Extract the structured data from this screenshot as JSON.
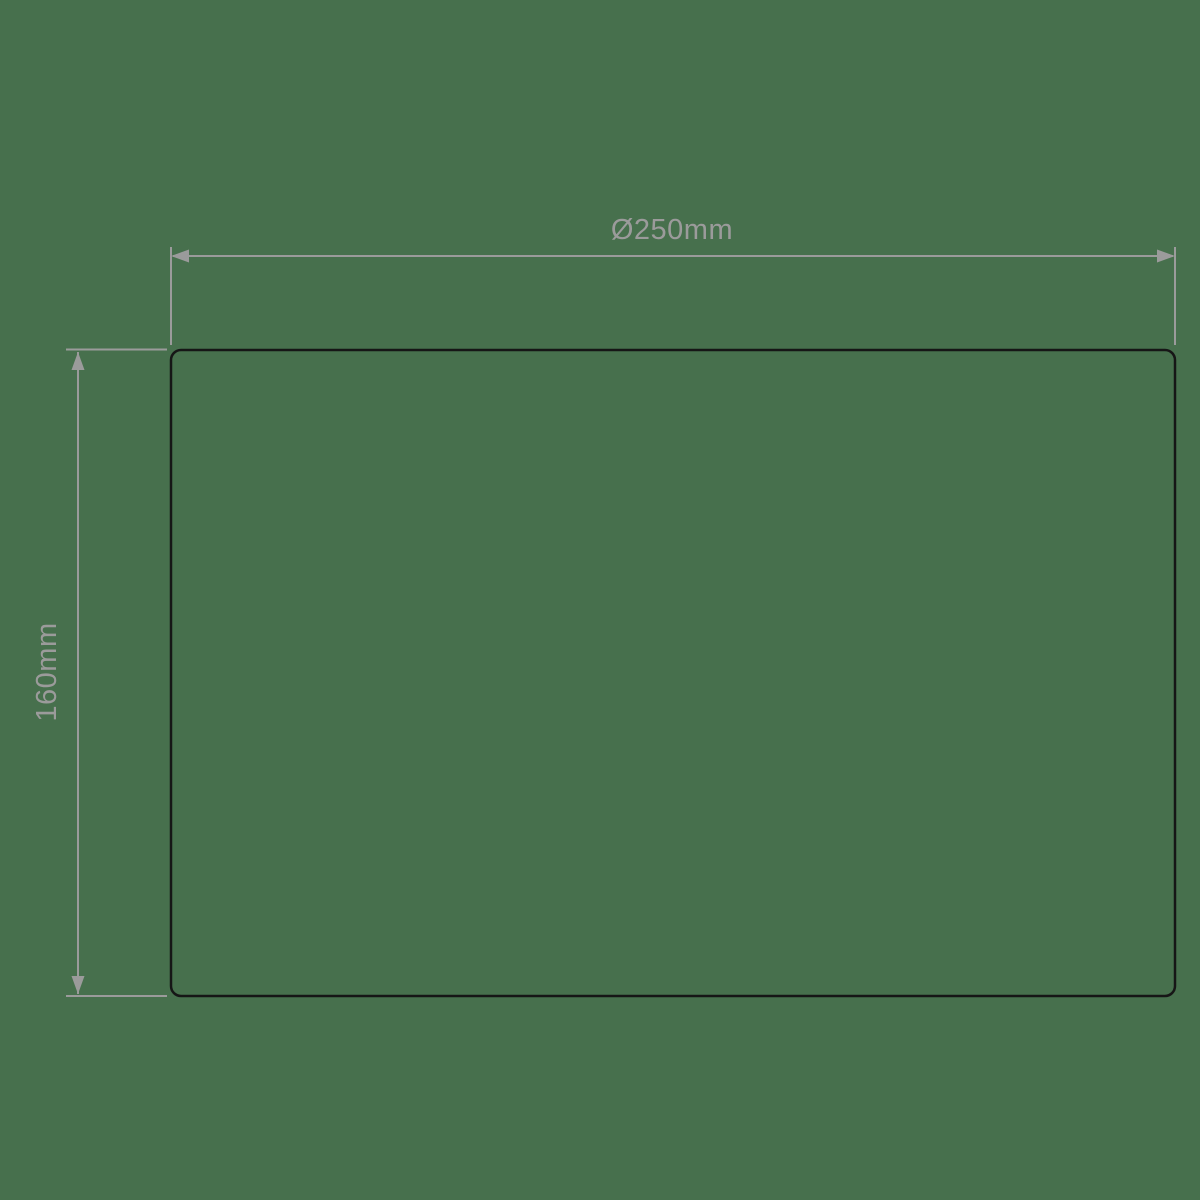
{
  "colors": {
    "background": "#47704D",
    "line": "#9B9B9B",
    "outline": "#161616"
  },
  "diagram": {
    "width_dimension": {
      "label": "Ø250mm"
    },
    "height_dimension": {
      "label": "160mm"
    }
  }
}
